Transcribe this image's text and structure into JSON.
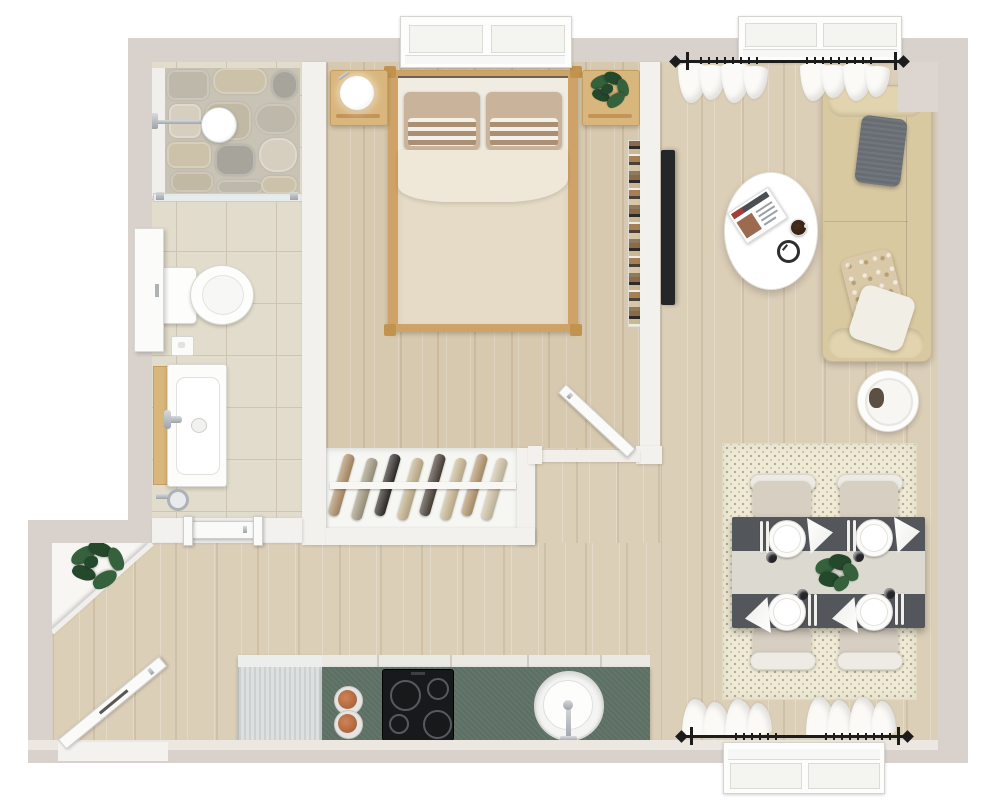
{
  "scene": {
    "kind": "3d-floor-plan-top-view",
    "width_px": 1000,
    "height_px": 806
  },
  "palette": {
    "wallExt": "#d9d2cc",
    "wallEdge": "#c7beb8",
    "wallInt": "#f3f1ee",
    "wood": "#dccfb8",
    "woodBed": "#d7c9af",
    "tile": "#e1dccb",
    "tileLine": "#cbc5b2",
    "stone": "#c9c3b5",
    "closetFloor": "#f6f6f3",
    "counter": "#5c6f63",
    "counterEdge": "#ebe9e4",
    "cooktop": "#17191b",
    "copper": "#c07a50",
    "sofa": "#d9c9a1",
    "sofaBolster": "#e2d4ae",
    "pGray": "#686d73",
    "pWhite": "#f1eee6",
    "pFloral": "#d9c9a8",
    "tableDark": "#53565a",
    "runner": "#dcd9d1",
    "chairSeat": "#d6cfc2",
    "chairBack": "#edebe4",
    "rug": "#f0ebd6",
    "bedFrame": "#cfa368",
    "mattress": "#f1ece1",
    "duvet": "#e5dbc6",
    "sheet": "#efe8d8",
    "pillowTan": "#c9b49b",
    "woodFurn": "#d9b67c",
    "green": "#35613c",
    "greenDark": "#24482b",
    "tv": "#24272a",
    "rod": "#1c1c1c",
    "door": "#fafaf9",
    "chrome": "#b9bdc1"
  },
  "rooms": {
    "bathroom": {
      "label": "bathroom",
      "features": [
        "walk-in-shower",
        "stone-shower-wall",
        "rain-shower-head",
        "glass-divider",
        "toilet",
        "flush-plate",
        "vanity-sink",
        "chrome-faucet",
        "wall-cabinet",
        "tiled-floor",
        "door-to-hall"
      ]
    },
    "bedroom": {
      "label": "bedroom",
      "features": [
        "window",
        "double-bed",
        "striped-pillows",
        "beige-duvet",
        "nightstand-with-lamp",
        "nightstand-with-plant",
        "book-ledge",
        "door-to-living-area"
      ]
    },
    "closet": {
      "label": "open-wardrobe",
      "features": [
        "clothes-rail",
        "hanging-clothes"
      ],
      "hanger_count": 8
    },
    "hallway": {
      "label": "entry-hall",
      "features": [
        "entry-door",
        "corner-plant",
        "diagonal-wall"
      ]
    },
    "kitchen": {
      "label": "kitchenette",
      "features": [
        "refrigerator",
        "green-countertop",
        "induction-cooktop",
        "copper-pans",
        "round-sink",
        "faucet"
      ],
      "burner_count": 4,
      "pan_count": 2
    },
    "living": {
      "label": "living-room",
      "features": [
        "window-with-curtains",
        "black-curtain-rod",
        "fabric-sofa",
        "gray-cushion",
        "floral-cushion",
        "white-cushion",
        "oval-coffee-table",
        "magazine",
        "espresso-cup",
        "clock-coaster",
        "round-side-table",
        "wall-mounted-tv"
      ],
      "cushion_count": 3
    },
    "dining": {
      "label": "dining-area",
      "features": [
        "window-with-curtains",
        "black-curtain-rod",
        "dark-dining-table",
        "table-runner",
        "plant-centerpiece",
        "cream-rug"
      ],
      "seat_count": 4,
      "place_setting_count": 4
    }
  },
  "counts": {
    "windows": 3,
    "doors": 3,
    "dining_chairs": 4,
    "place_settings": 4,
    "cooktop_burners": 4,
    "clothes_hangers": 8,
    "curtain_bunches": 4
  },
  "closet_clothes_colors": [
    "#b08f68",
    "#a39a82",
    "#2f2b27",
    "#c3b28c",
    "#4a4138",
    "#cbb893",
    "#b5976e",
    "#cfc3a6"
  ],
  "shower_stone_colors": [
    "#bdb8a9",
    "#ccc2a9",
    "#a7a59b",
    "#d6cfc0",
    "#c2b9a4"
  ]
}
